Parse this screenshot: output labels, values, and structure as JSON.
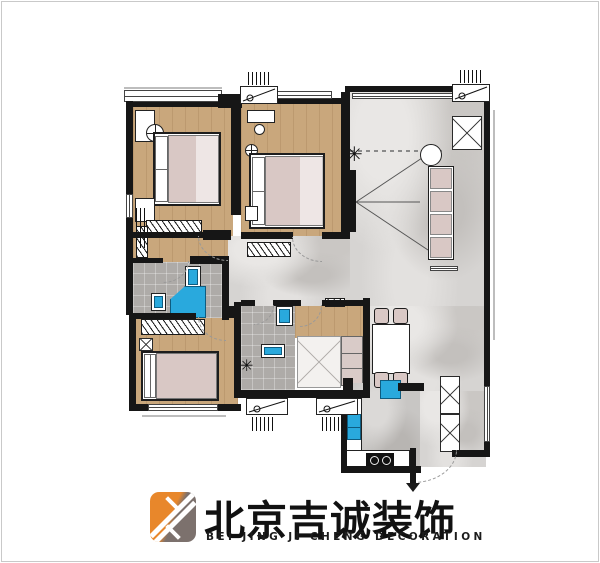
{
  "brand": {
    "name_cn": "北京吉诚装饰",
    "name_en": "BEI JING JI CHENG DECORATION",
    "logo_orange": "#E8872B",
    "logo_brown": "#7C716D"
  },
  "palette": {
    "wall": "#161616",
    "wood_floor": "#C9A77C",
    "marble_floor": "#D6D4D2",
    "bath_tile": "#AEABA8",
    "fixture_blue": "#29A9DD",
    "bedding_pink": "#D9C8C5"
  },
  "glyphs": {
    "plant": "✳"
  },
  "rooms": [
    "master-bedroom",
    "bedroom-2",
    "bedroom-3",
    "living-room",
    "dining-area",
    "master-bathroom",
    "bathroom-2",
    "study",
    "kitchen",
    "entry"
  ]
}
